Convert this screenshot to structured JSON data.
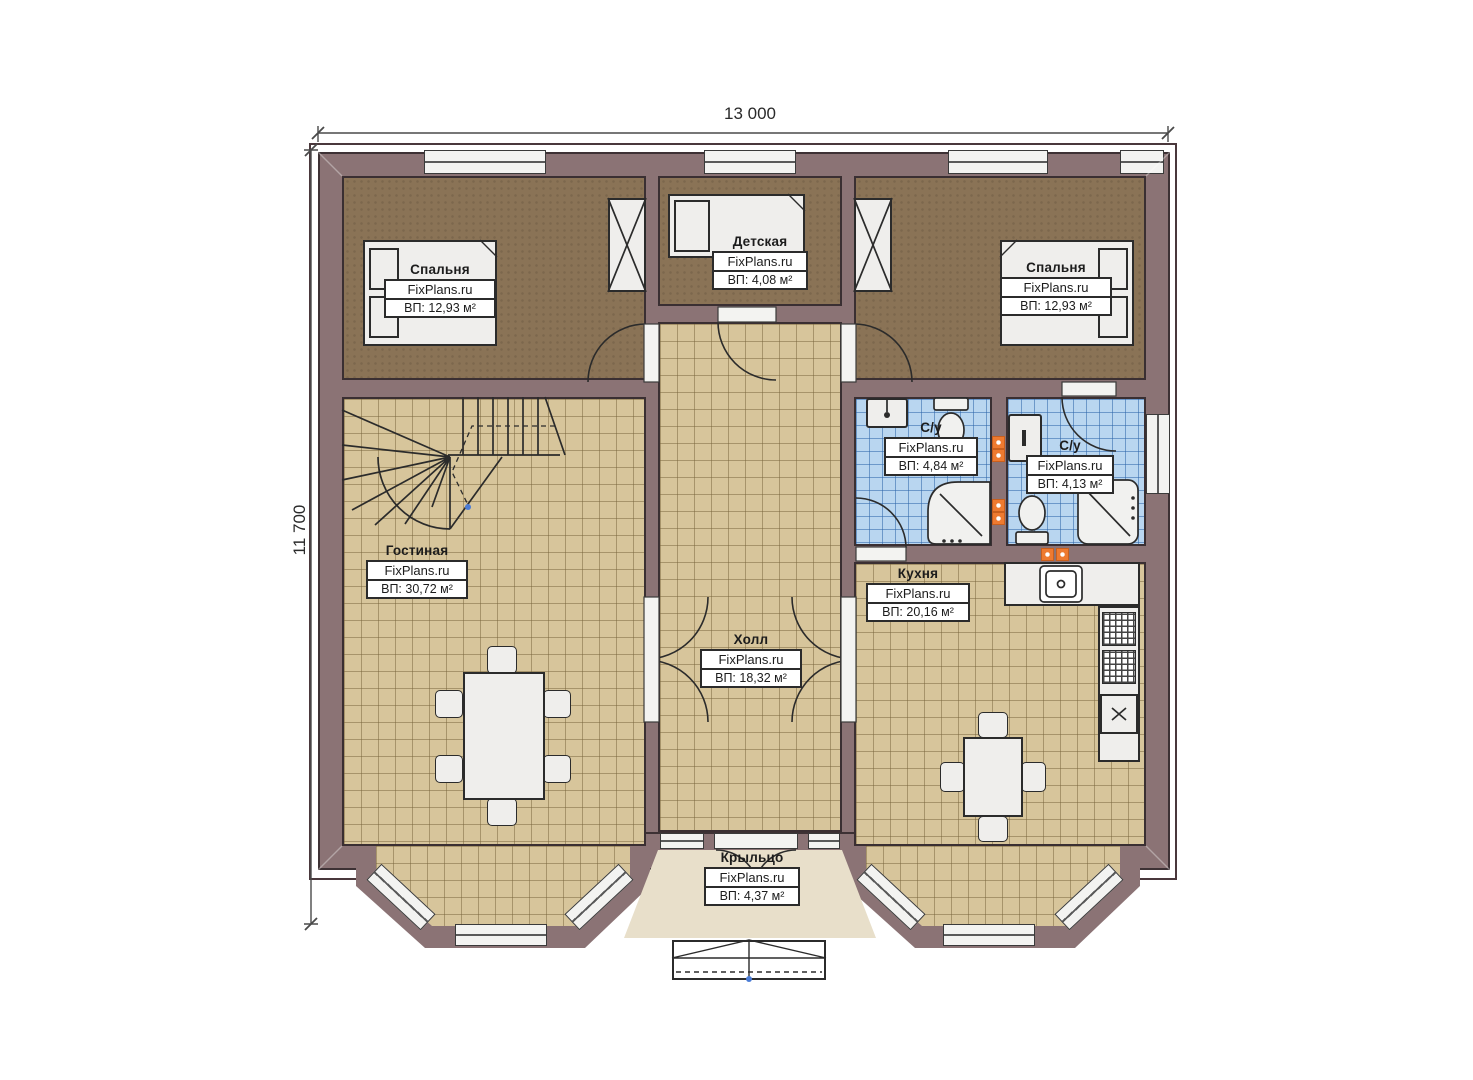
{
  "title": "План первого этажа",
  "dimensions": {
    "width_label": "13 000",
    "height_label": "11 700"
  },
  "brand": "FixPlans.ru",
  "rooms": {
    "bedroom_left": {
      "name": "Спальня",
      "brand": "FixPlans.ru",
      "area": "ВП: 12,93 м²"
    },
    "nursery": {
      "name": "Детская",
      "brand": "FixPlans.ru",
      "area": "ВП: 4,08 м²"
    },
    "bedroom_right": {
      "name": "Спальня",
      "brand": "FixPlans.ru",
      "area": "ВП: 12,93 м²"
    },
    "bath_1": {
      "name": "С/у",
      "brand": "FixPlans.ru",
      "area": "ВП: 4,84 м²"
    },
    "bath_2": {
      "name": "С/у",
      "brand": "FixPlans.ru",
      "area": "ВП: 4,13 м²"
    },
    "living": {
      "name": "Гостиная",
      "brand": "FixPlans.ru",
      "area": "ВП: 30,72 м²"
    },
    "hall": {
      "name": "Холл",
      "brand": "FixPlans.ru",
      "area": "ВП: 18,32 м²"
    },
    "kitchen": {
      "name": "Кухня",
      "brand": "FixPlans.ru",
      "area": "ВП: 20,16 м²"
    },
    "porch": {
      "name": "Крыльцо",
      "brand": "FixPlans.ru",
      "area": "ВП: 4,37 м²"
    }
  },
  "colors": {
    "wall": "#8b7375",
    "wall_line": "#3d3134",
    "tile_floor": "#d7c59b",
    "bath_tile": "#b9d6f0",
    "carpet": "#8a7356",
    "porch_floor": "#e8dfca",
    "marker_orange": "#ee7a30"
  }
}
